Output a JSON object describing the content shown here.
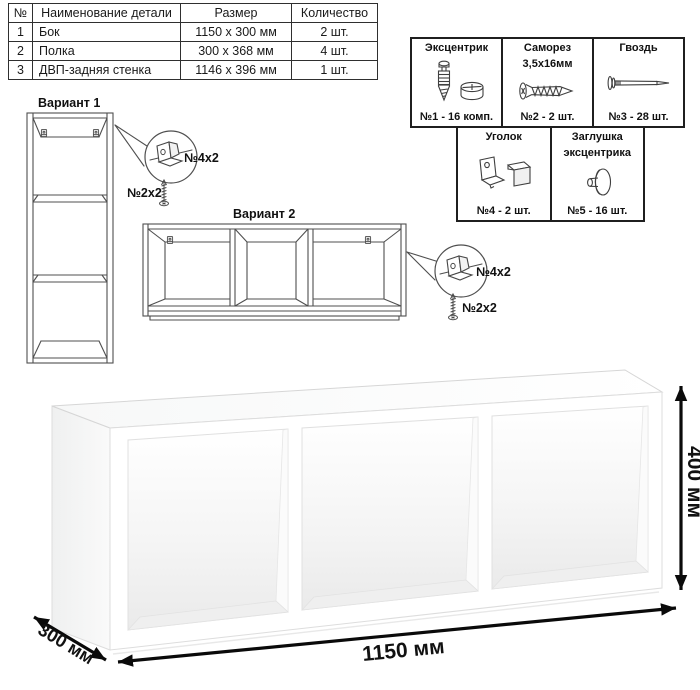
{
  "parts_table": {
    "headers": {
      "num": "№",
      "name": "Наименование детали",
      "size": "Размер",
      "qty": "Количество"
    },
    "rows": [
      {
        "num": "1",
        "name": "Бок",
        "size": "1150 x 300 мм",
        "qty": "2 шт."
      },
      {
        "num": "2",
        "name": "Полка",
        "size": "300 x 368 мм",
        "qty": "4 шт."
      },
      {
        "num": "3",
        "name": "ДВП-задняя стенка",
        "size": "1146 x 396 мм",
        "qty": "1 шт."
      }
    ]
  },
  "hardware": {
    "cells": [
      {
        "icon": "cam-bolt-icon",
        "title1": "Эксцентрик",
        "title2": "",
        "count": "№1 - 16 комп."
      },
      {
        "icon": "screw-icon",
        "title1": "Саморез",
        "title2": "3,5х16мм",
        "count": "№2 - 2 шт."
      },
      {
        "icon": "nail-icon",
        "title1": "Гвоздь",
        "title2": "",
        "count": "№3 - 28 шт."
      },
      {
        "icon": "bracket-icon",
        "title1": "Уголок",
        "title2": "",
        "count": "№4 - 2 шт."
      },
      {
        "icon": "cam-cap-icon",
        "title1": "Заглушка",
        "title2": "эксцентрика",
        "count": "№5 - 16 шт."
      }
    ]
  },
  "variants": {
    "v1_label": "Вариант 1",
    "v2_label": "Вариант 2",
    "callout_bracket_label": "№4х2",
    "callout_screw_label": "№2х2"
  },
  "dimensions": {
    "width": "1150 мм",
    "height": "400 мм",
    "depth": "300 мм"
  },
  "colors": {
    "line": "#4f4f4f",
    "border": "#1f1f1f",
    "arrow": "#0a0a0a",
    "shade": "#ececec"
  }
}
